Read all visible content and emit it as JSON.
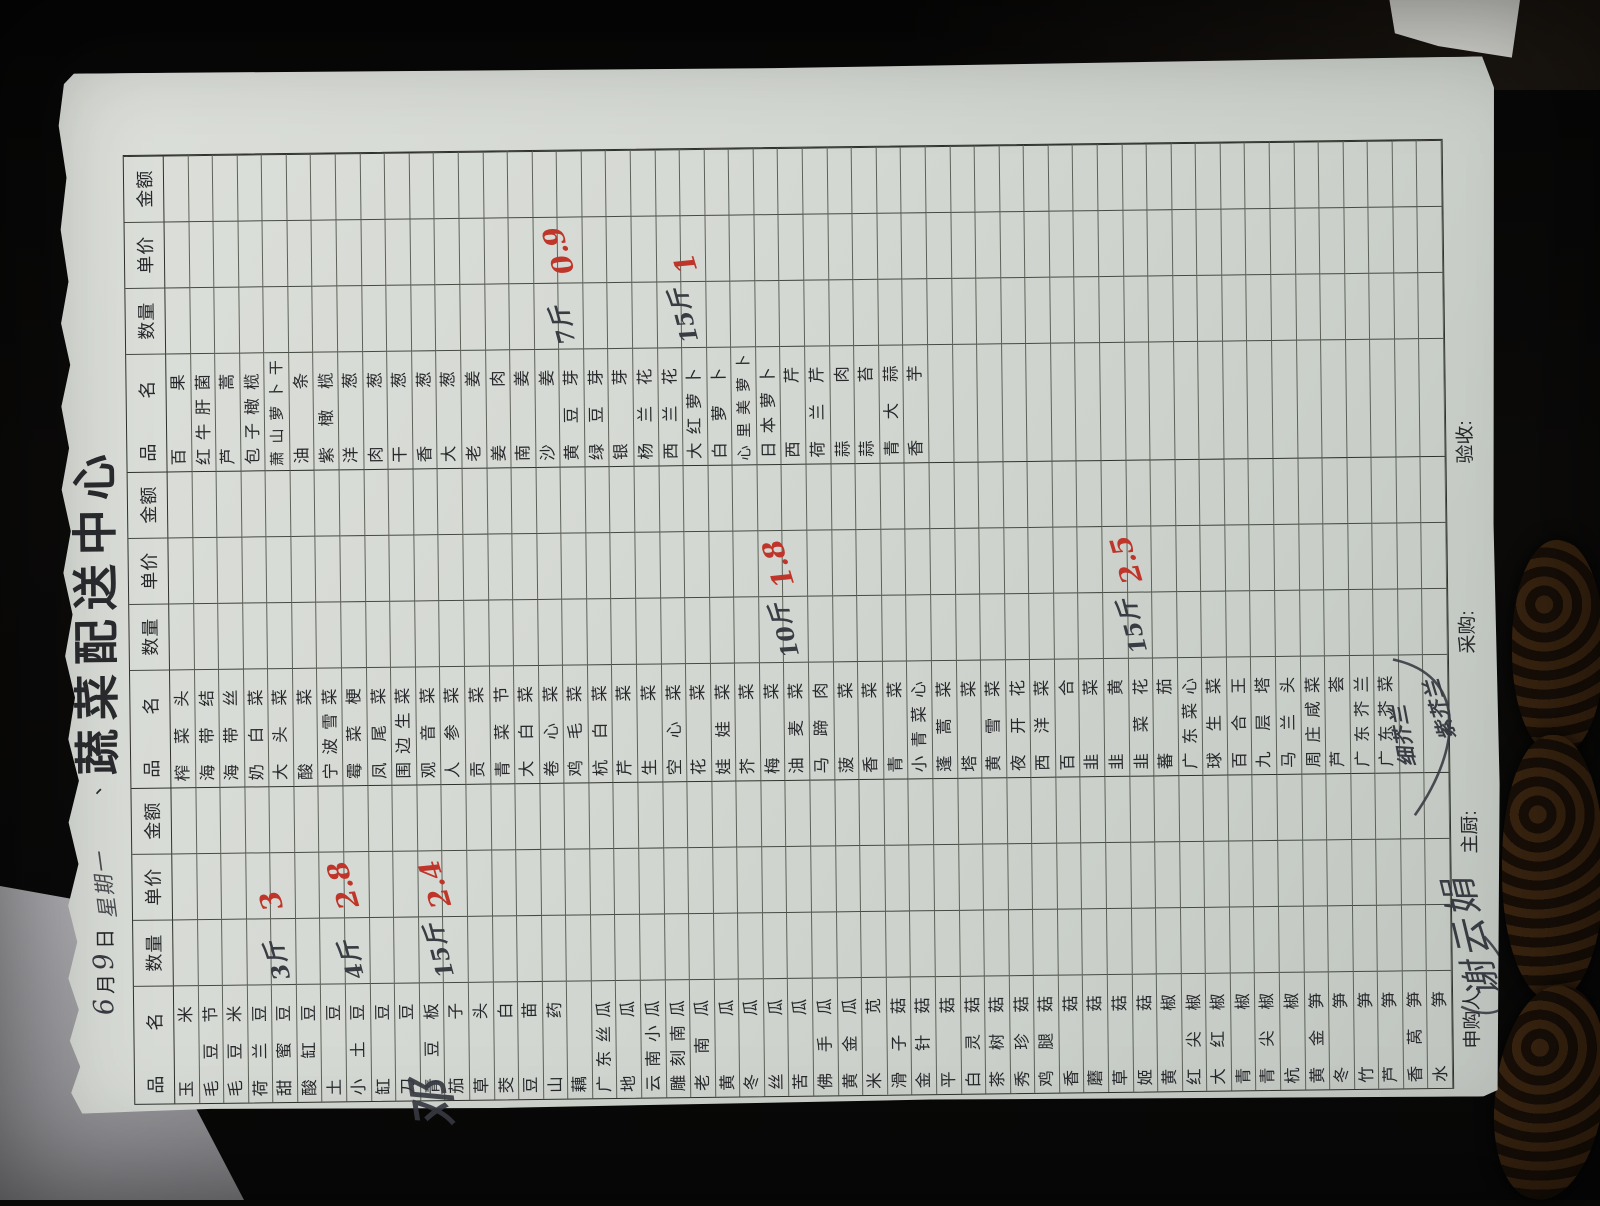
{
  "page": {
    "title_prefix": "、",
    "title": "蔬菜配送中心",
    "date": {
      "month_value": "6",
      "month_label": "月",
      "day_value": "9",
      "day_label": "日",
      "weekday_handwritten": "星期一"
    }
  },
  "table": {
    "header_labels": {
      "name": "品名",
      "qty": "数量",
      "price": "单价",
      "amount": "金额"
    },
    "group_count": 3,
    "row_count": 52,
    "groups": [
      {
        "names": [
          "玉米",
          "毛豆节",
          "毛豆米",
          "荷兰豆",
          "甜蜜豆",
          "酸缸豆",
          "土豆",
          "小土豆",
          "缸豆",
          "刀豆",
          "青豆板",
          "茄子",
          "草头",
          "茭白",
          "豆苗",
          "山药",
          "藕",
          "广东丝瓜",
          "地瓜",
          "云南小瓜",
          "雕刻南瓜",
          "老南瓜",
          "黄瓜",
          "冬瓜",
          "丝瓜",
          "苦瓜",
          "佛手瓜",
          "黄金瓜",
          "米苋",
          "滑子菇",
          "金针菇",
          "平菇",
          "白灵菇",
          "茶树菇",
          "秀珍菇",
          "鸡腿菇",
          "香菇",
          "蘑菇",
          "草菇",
          "姬菇",
          "黄椒",
          "红尖椒",
          "大红椒",
          "青椒",
          "青尖椒",
          "杭椒",
          "黄金笋",
          "冬笋",
          "竹笋",
          "芦笋",
          "香莴笋",
          "水笋"
        ]
      },
      {
        "names": [
          "榨菜头",
          "海带结",
          "海带丝",
          "奶白菜",
          "大头菜",
          "酸菜",
          "宁波雪菜",
          "霉菜梗",
          "凤尾菜",
          "围边生菜",
          "观音菜",
          "人参菜",
          "贡菜",
          "青菜节",
          "大白菜",
          "卷心菜",
          "鸡毛菜",
          "杭白菜",
          "芹菜",
          "生菜",
          "空心菜",
          "花菜",
          "娃娃菜",
          "芥菜",
          "梅菜",
          "油麦菜",
          "马蹄肉",
          "菠菜",
          "香菜",
          "青菜",
          "小青菜心",
          "蓬蒿菜",
          "塔菜",
          "黄雪菜",
          "夜开花",
          "西洋菜",
          "百合",
          "韭菜",
          "韭黄",
          "韭菜花",
          "蕃茄",
          "广东菜心",
          "球生菜",
          "百合王",
          "九层塔",
          "马兰头",
          "周庄咸菜",
          "芦荟",
          "广东芥兰",
          "广东芥菜",
          "",
          ""
        ]
      },
      {
        "names": [
          "百果",
          "红牛肝菌",
          "芦蒿",
          "包子橄榄",
          "萧山萝卜干",
          "油条",
          "紫橄榄",
          "洋葱",
          "肉葱",
          "干葱",
          "香葱",
          "大葱",
          "老姜",
          "姜肉",
          "南姜",
          "沙姜",
          "黄豆芽",
          "绿豆芽",
          "银芽",
          "杨兰花",
          "西兰花",
          "大红萝卜",
          "白萝卜",
          "心里美萝卜",
          "日本萝卜",
          "西芹",
          "荷兰芹",
          "蒜肉",
          "蒜苔",
          "青大蒜",
          "香芋",
          "",
          "",
          "",
          "",
          "",
          "",
          "",
          "",
          "",
          "",
          "",
          "",
          "",
          "",
          "",
          "",
          "",
          "",
          "",
          "",
          ""
        ]
      }
    ],
    "handwritten_names": [
      {
        "group": 2,
        "row": 51,
        "text": "细芥兰"
      },
      {
        "group": 2,
        "row": 52,
        "text": "紫芥兰"
      }
    ],
    "annotations": [
      {
        "group": 1,
        "row": 5,
        "item": "甜蜜豆",
        "qty": "3斤",
        "price": "3"
      },
      {
        "group": 1,
        "row": 8,
        "item": "小土豆",
        "qty": "4斤",
        "price": "2.8"
      },
      {
        "group": 1,
        "row": 12,
        "item": "茄子",
        "qty": "15斤",
        "price": "2.4"
      },
      {
        "group": 2,
        "row": 26,
        "item": "油麦菜",
        "qty": "10斤",
        "price": "1.8"
      },
      {
        "group": 2,
        "row": 40,
        "item": "韭菜花",
        "qty": "15斤",
        "price": "2.5"
      },
      {
        "group": 3,
        "row": 17,
        "item": "黄豆芽",
        "qty": "7斤",
        "price": "0.9"
      },
      {
        "group": 3,
        "row": 22,
        "item": "大红萝卜",
        "qty": "15斤",
        "price": "1"
      }
    ]
  },
  "footer": {
    "requester_label": "申购人:",
    "requester_signature": "谢云娟",
    "chef_label": "主厨:",
    "buyer_label": "采购:",
    "receiver_label": "验收:"
  },
  "margin_scribble": "邓",
  "colors": {
    "paper": "#d4d8d2",
    "grid_line": "#3c403a",
    "printed_text": "#27282c",
    "red_ink": "#bf3529",
    "dark_ink": "#3a3c44"
  }
}
